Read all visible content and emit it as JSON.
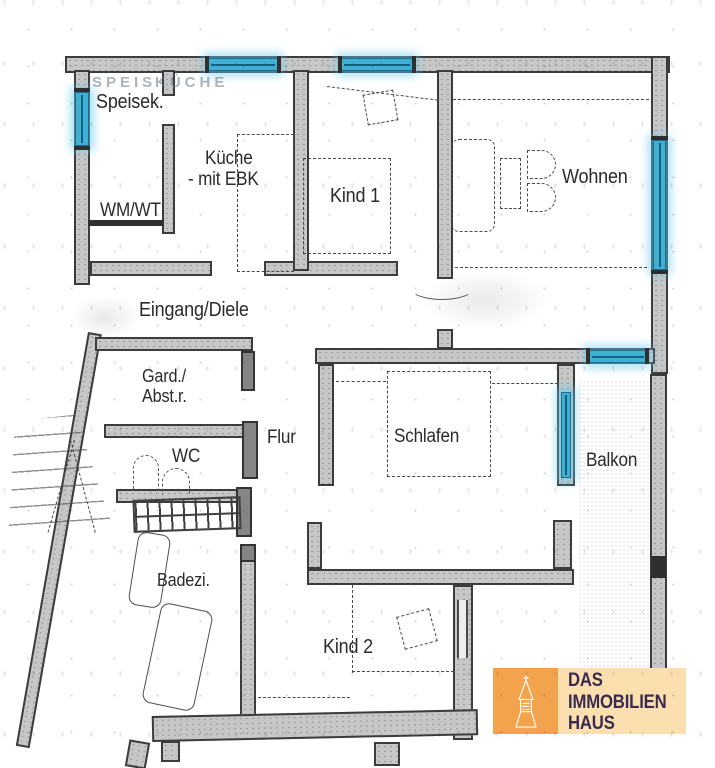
{
  "rooms": {
    "speisek": {
      "label": "Speisek."
    },
    "kueche": {
      "label": "Küche",
      "label2": "- mit EBK"
    },
    "kind1": {
      "label": "Kind 1"
    },
    "wohnen": {
      "label": "Wohnen"
    },
    "wmwt": {
      "label": "WM/WT"
    },
    "eingang": {
      "label": "Eingang/Diele"
    },
    "gard": {
      "label": "Gard./",
      "label2": "Abst.r."
    },
    "flur": {
      "label": "Flur"
    },
    "wc": {
      "label": "WC"
    },
    "schlafen": {
      "label": "Schlafen"
    },
    "balkon": {
      "label": "Balkon"
    },
    "badezi": {
      "label": "Badezi."
    },
    "kind2": {
      "label": "Kind 2"
    }
  },
  "ghost": {
    "left": "SPEIS",
    "right": "KÜCHE"
  },
  "logo": {
    "line1": "DAS",
    "line2": "IMMOBILIEN",
    "line3": "HAUS"
  },
  "colors": {
    "window_cyan": "#3fb0d4",
    "window_glow": "#61c9eb",
    "wall_dark": "#3c3c3c",
    "wall_fill": "#c7c7c7",
    "logo_orange": "#f2a34b",
    "logo_peach": "#fbdfae",
    "logo_text": "#3b2b50"
  }
}
